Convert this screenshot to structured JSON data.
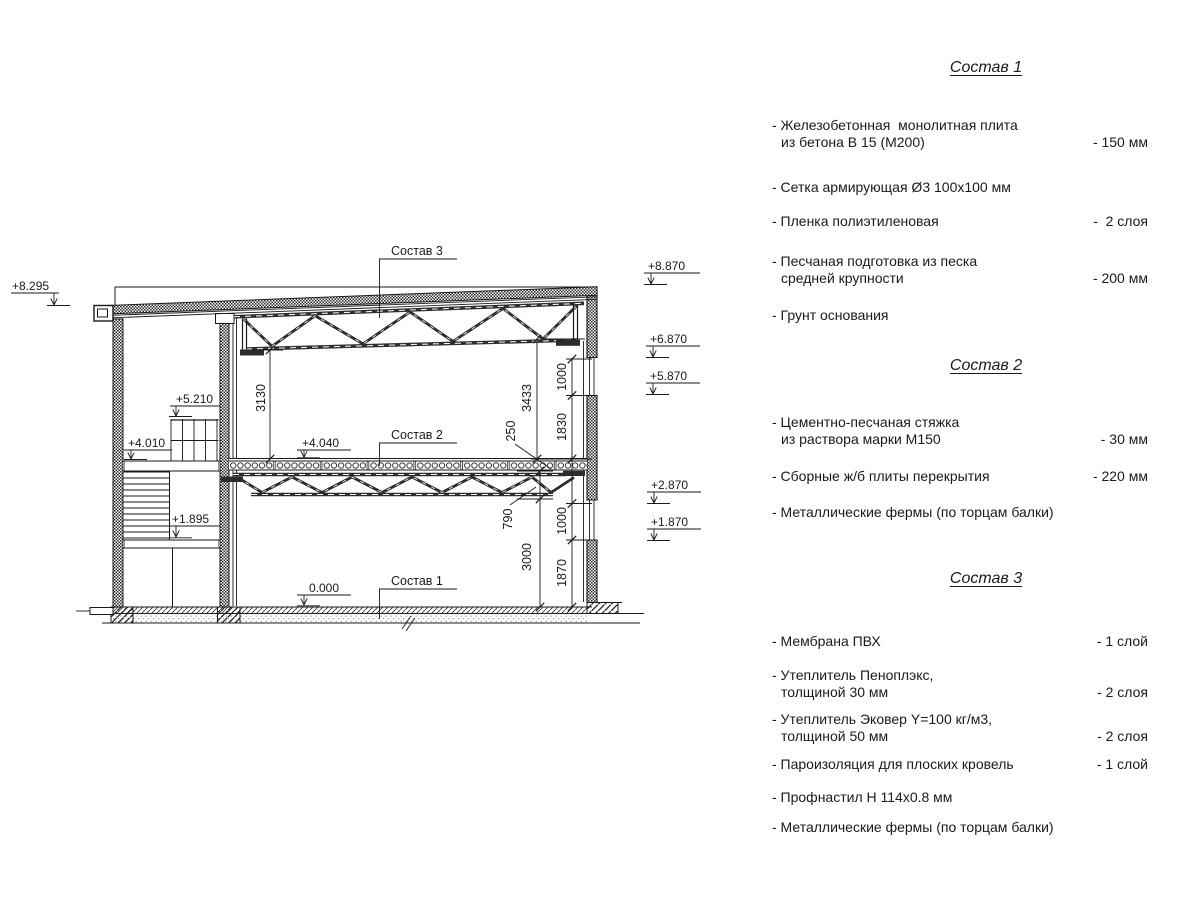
{
  "page": {
    "background": "#ffffff",
    "line_color": "#1a1a1a"
  },
  "drawing": {
    "levels": {
      "l8295": "+8.295",
      "l8870": "+8.870",
      "l6870": "+6.870",
      "l5870": "+5.870",
      "l2870": "+2.870",
      "l1870": "+1.870",
      "l5210": "+5.210",
      "l4010": "+4.010",
      "l4040": "+4.040",
      "l1895": "+1.895",
      "l0000": "0.000"
    },
    "callouts": {
      "c1": "Состав 1",
      "c2": "Состав 2",
      "c3": "Состав 3"
    },
    "dims": {
      "d3130": "3130",
      "d3433": "3433",
      "d250": "250",
      "d1830": "1830",
      "d1000a": "1000",
      "d1000b": "1000",
      "d1870": "1870",
      "d790": "790",
      "d3000": "3000"
    }
  },
  "specs": [
    {
      "title": "Состав 1",
      "items": [
        {
          "line1": "- Железобетонная  монолитная плита",
          "line2": "из бетона В 15 (М200)",
          "value": "- 150 мм"
        },
        {
          "line1": "- Сетка армирующая Ø3 100х100 мм",
          "line2": "",
          "value": ""
        },
        {
          "line1": "- Пленка полиэтиленовая",
          "line2": "",
          "value": "-  2 слоя"
        },
        {
          "line1": "- Песчаная подготовка из песка",
          "line2": "средней крупности",
          "value": "- 200 мм"
        },
        {
          "line1": "- Грунт основания",
          "line2": "",
          "value": ""
        }
      ]
    },
    {
      "title": "Состав 2",
      "items": [
        {
          "line1": "- Цементно-песчаная стяжка",
          "line2": "из раствора марки М150",
          "value": "- 30 мм"
        },
        {
          "line1": "- Сборные ж/б плиты перекрытия",
          "line2": "",
          "value": "- 220 мм"
        },
        {
          "line1": "- Металлические фермы (по торцам балки)",
          "line2": "",
          "value": ""
        }
      ]
    },
    {
      "title": "Состав 3",
      "items": [
        {
          "line1": "- Мембрана ПВХ",
          "line2": "",
          "value": "- 1 слой"
        },
        {
          "line1": "- Утеплитель Пеноплэкс,",
          "line2": "толщиной 30 мм",
          "value": "- 2 слоя"
        },
        {
          "line1": "- Утеплитель Эковер Y=100 кг/м3,",
          "line2": "толщиной 50 мм",
          "value": "- 2 слоя"
        },
        {
          "line1": "- Пароизоляция для плоских кровель",
          "line2": "",
          "value": "- 1 слой"
        },
        {
          "line1": "- Профнастил Н 114х0.8 мм",
          "line2": "",
          "value": ""
        },
        {
          "line1": "- Металлические фермы (по торцам балки)",
          "line2": "",
          "value": ""
        }
      ]
    }
  ]
}
